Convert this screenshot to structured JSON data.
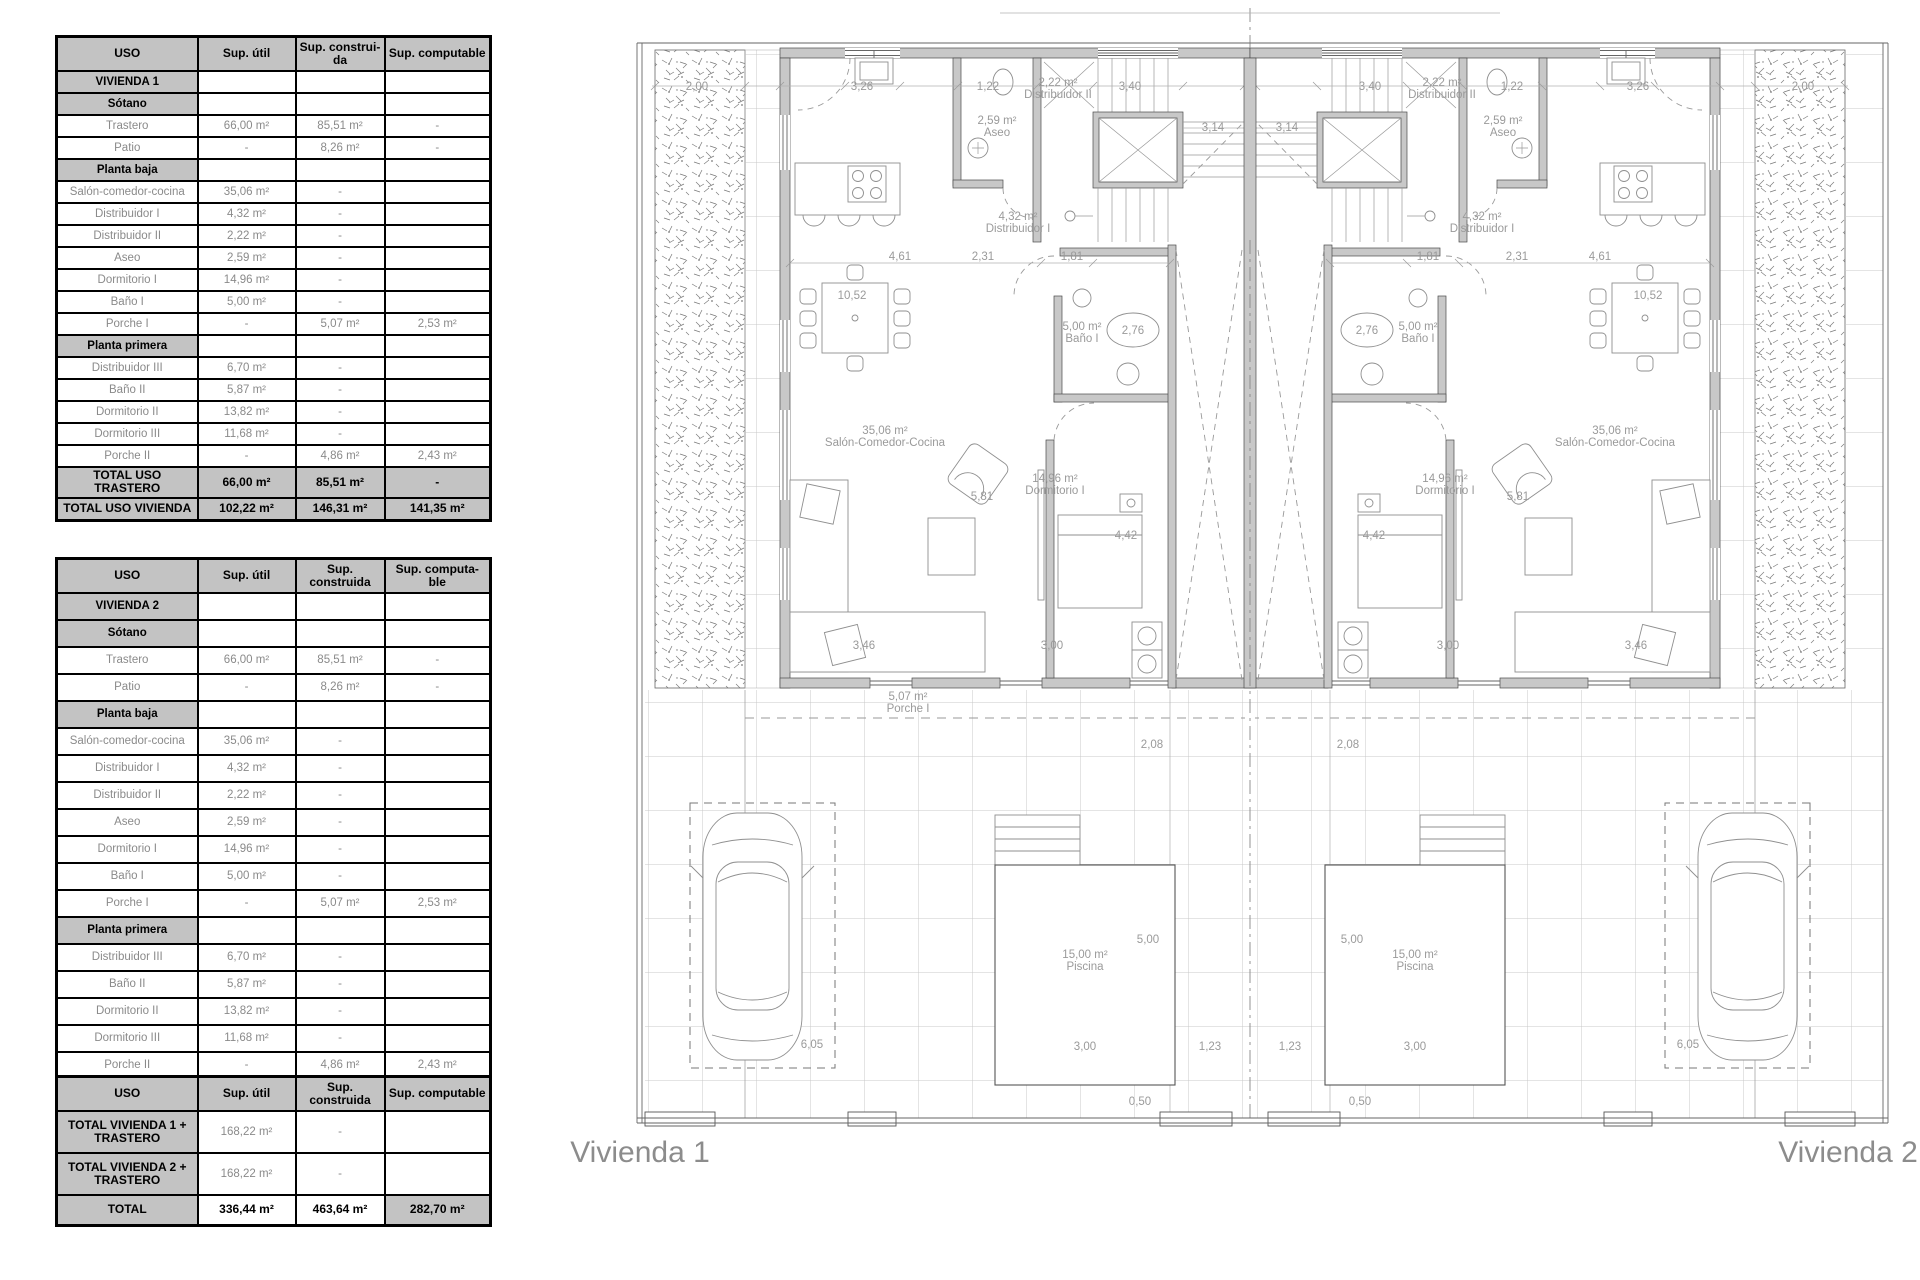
{
  "colors": {
    "table_header_bg": "#c3c3c3",
    "data_text": "#8a8a8a",
    "wall_fill": "#c8c8c8",
    "plan_text": "#9a9a9a",
    "title_text": "#8c8c8c"
  },
  "tables": {
    "table1": {
      "headers": [
        "USO",
        "Sup. útil",
        "Sup. construi-\nda",
        "Sup. computable"
      ],
      "rows": [
        [
          "section",
          "VIVIENDA 1",
          "",
          "",
          ""
        ],
        [
          "section",
          "Sótano",
          "",
          "",
          ""
        ],
        [
          "data",
          "Trastero",
          "66,00 m²",
          "85,51 m²",
          "-"
        ],
        [
          "data",
          "Patio",
          "-",
          "8,26 m²",
          "-"
        ],
        [
          "section",
          "Planta baja",
          "",
          "",
          ""
        ],
        [
          "data",
          "Salón-comedor-cocina",
          "35,06 m²",
          "-",
          ""
        ],
        [
          "data",
          "Distribuidor I",
          "4,32 m²",
          "-",
          ""
        ],
        [
          "data",
          "Distribuidor II",
          "2,22 m²",
          "-",
          ""
        ],
        [
          "data",
          "Aseo",
          "2,59 m²",
          "-",
          ""
        ],
        [
          "data",
          "Dormitorio I",
          "14,96 m²",
          "-",
          ""
        ],
        [
          "data",
          "Baño I",
          "5,00 m²",
          "-",
          ""
        ],
        [
          "data",
          "Porche I",
          "-",
          "5,07 m²",
          "2,53 m²"
        ],
        [
          "section",
          "Planta primera",
          "",
          "",
          ""
        ],
        [
          "data",
          "Distribuidor III",
          "6,70 m²",
          "-",
          ""
        ],
        [
          "data",
          "Baño II",
          "5,87 m²",
          "-",
          ""
        ],
        [
          "data",
          "Dormitorio II",
          "13,82 m²",
          "-",
          ""
        ],
        [
          "data",
          "Dormitorio III",
          "11,68 m²",
          "-",
          ""
        ],
        [
          "data",
          "Porche II",
          "-",
          "4,86 m²",
          "2,43 m²"
        ],
        [
          "total",
          "TOTAL USO TRASTERO",
          "66,00 m²",
          "85,51 m²",
          "-"
        ],
        [
          "total",
          "TOTAL USO VIVIENDA",
          "102,22 m²",
          "146,31 m²",
          "141,35 m²"
        ]
      ]
    },
    "table2": {
      "headers": [
        "USO",
        "Sup. útil",
        "Sup. construida",
        "Sup. computa-\nble"
      ],
      "rows": [
        [
          "section",
          "VIVIENDA 2",
          "",
          "",
          ""
        ],
        [
          "section",
          "Sótano",
          "",
          "",
          ""
        ],
        [
          "data",
          "Trastero",
          "66,00 m²",
          "85,51 m²",
          "-"
        ],
        [
          "data",
          "Patio",
          "-",
          "8,26 m²",
          "-"
        ],
        [
          "section",
          "Planta baja",
          "",
          "",
          ""
        ],
        [
          "data",
          "Salón-comedor-cocina",
          "35,06 m²",
          "-",
          ""
        ],
        [
          "data",
          "Distribuidor I",
          "4,32 m²",
          "-",
          ""
        ],
        [
          "data",
          "Distribuidor II",
          "2,22 m²",
          "-",
          ""
        ],
        [
          "data",
          "Aseo",
          "2,59 m²",
          "-",
          ""
        ],
        [
          "data",
          "Dormitorio I",
          "14,96 m²",
          "-",
          ""
        ],
        [
          "data",
          "Baño I",
          "5,00 m²",
          "-",
          ""
        ],
        [
          "data",
          "Porche I",
          "-",
          "5,07 m²",
          "2,53 m²"
        ],
        [
          "section",
          "Planta primera",
          "",
          "",
          ""
        ],
        [
          "data",
          "Distribuidor III",
          "6,70 m²",
          "-",
          ""
        ],
        [
          "data",
          "Baño II",
          "5,87 m²",
          "-",
          ""
        ],
        [
          "data",
          "Dormitorio II",
          "13,82 m²",
          "-",
          ""
        ],
        [
          "data",
          "Dormitorio III",
          "11,68 m²",
          "-",
          ""
        ],
        [
          "data",
          "Porche II",
          "-",
          "4,86 m²",
          "2,43 m²"
        ],
        [
          "total",
          "TOTAL USO TRASTERO",
          "66,00 m²",
          "85,51 m²",
          "-"
        ],
        [
          "total",
          "TOTAL USO VIVIENDA",
          "102,22 m²",
          "146,31 m²",
          "141,35 m²"
        ]
      ]
    },
    "table3": {
      "headers": [
        "USO",
        "Sup. útil",
        "Sup. construida",
        "Sup. computable"
      ],
      "rows": [
        [
          "total2",
          "TOTAL VIVIENDA 1 +\nTRASTERO",
          "168,22 m²",
          "-",
          ""
        ],
        [
          "total2",
          "TOTAL VIVIENDA 2 +\nTRASTERO",
          "168,22 m²",
          "-",
          ""
        ],
        [
          "grand",
          "TOTAL",
          "336,44 m²",
          "463,64 m²",
          "282,70 m²"
        ]
      ]
    }
  },
  "plan": {
    "texts": [
      {
        "t": "Vivienda 1",
        "x": 640,
        "y": 1162,
        "cls": "title",
        "anchor": "start",
        "name": "title-vivienda-1"
      },
      {
        "t": "Vivienda 2",
        "x": 1848,
        "y": 1162,
        "cls": "title",
        "anchor": "end",
        "name": "title-vivienda-2"
      },
      {
        "t": "2,59 m²",
        "x": 997,
        "y": 124
      },
      {
        "t": "Aseo",
        "x": 997,
        "y": 136
      },
      {
        "t": "2,59 m²",
        "x": 1503,
        "y": 124
      },
      {
        "t": "Aseo",
        "x": 1503,
        "y": 136
      },
      {
        "t": "2,22 m²",
        "x": 1058,
        "y": 86
      },
      {
        "t": "Distribuidor II",
        "x": 1058,
        "y": 98
      },
      {
        "t": "2,22 m²",
        "x": 1442,
        "y": 86
      },
      {
        "t": "Distribuidor II",
        "x": 1442,
        "y": 98
      },
      {
        "t": "4,32 m²",
        "x": 1018,
        "y": 220
      },
      {
        "t": "Distribuidor I",
        "x": 1018,
        "y": 232
      },
      {
        "t": "4,32 m²",
        "x": 1482,
        "y": 220
      },
      {
        "t": "Distribuidor I",
        "x": 1482,
        "y": 232
      },
      {
        "t": "5,00 m²",
        "x": 1082,
        "y": 330
      },
      {
        "t": "Baño I",
        "x": 1082,
        "y": 342
      },
      {
        "t": "5,00 m²",
        "x": 1418,
        "y": 330
      },
      {
        "t": "Baño I",
        "x": 1418,
        "y": 342
      },
      {
        "t": "35,06 m²",
        "x": 885,
        "y": 434
      },
      {
        "t": "Salón-Comedor-Cocina",
        "x": 885,
        "y": 446
      },
      {
        "t": "35,06 m²",
        "x": 1615,
        "y": 434
      },
      {
        "t": "Salón-Comedor-Cocina",
        "x": 1615,
        "y": 446
      },
      {
        "t": "14,96 m²",
        "x": 1055,
        "y": 482
      },
      {
        "t": "Dormitorio I",
        "x": 1055,
        "y": 494
      },
      {
        "t": "14,96 m²",
        "x": 1445,
        "y": 482
      },
      {
        "t": "Dormitorio I",
        "x": 1445,
        "y": 494
      },
      {
        "t": "15,00 m²",
        "x": 1085,
        "y": 958
      },
      {
        "t": "Piscina",
        "x": 1085,
        "y": 970
      },
      {
        "t": "15,00 m²",
        "x": 1415,
        "y": 958
      },
      {
        "t": "Piscina",
        "x": 1415,
        "y": 970
      },
      {
        "t": "5,07 m²",
        "x": 908,
        "y": 700
      },
      {
        "t": "Porche I",
        "x": 908,
        "y": 712
      },
      {
        "t": "2,76",
        "x": 1133,
        "y": 334
      },
      {
        "t": "2,76",
        "x": 1367,
        "y": 334
      },
      {
        "t": "2,00",
        "x": 697,
        "y": 90
      },
      {
        "t": "2,00",
        "x": 1803,
        "y": 90
      },
      {
        "t": "3,26",
        "x": 862,
        "y": 90
      },
      {
        "t": "3,26",
        "x": 1638,
        "y": 90
      },
      {
        "t": "1,22",
        "x": 988,
        "y": 90
      },
      {
        "t": "1,22",
        "x": 1512,
        "y": 90
      },
      {
        "t": "3,40",
        "x": 1130,
        "y": 90
      },
      {
        "t": "3,40",
        "x": 1370,
        "y": 90
      },
      {
        "t": "3,14",
        "x": 1213,
        "y": 131
      },
      {
        "t": "3,14",
        "x": 1287,
        "y": 131
      },
      {
        "t": "4,61",
        "x": 900,
        "y": 260
      },
      {
        "t": "4,61",
        "x": 1600,
        "y": 260
      },
      {
        "t": "2,31",
        "x": 983,
        "y": 260
      },
      {
        "t": "2,31",
        "x": 1517,
        "y": 260
      },
      {
        "t": "1,81",
        "x": 1072,
        "y": 260
      },
      {
        "t": "1,81",
        "x": 1428,
        "y": 260
      },
      {
        "t": "10,52",
        "x": 852,
        "y": 299
      },
      {
        "t": "10,52",
        "x": 1648,
        "y": 299
      },
      {
        "t": "5,81",
        "x": 982,
        "y": 500
      },
      {
        "t": "5,81",
        "x": 1518,
        "y": 500
      },
      {
        "t": "4,42",
        "x": 1126,
        "y": 539
      },
      {
        "t": "4,42",
        "x": 1374,
        "y": 539
      },
      {
        "t": "3,46",
        "x": 864,
        "y": 649
      },
      {
        "t": "3,46",
        "x": 1636,
        "y": 649
      },
      {
        "t": "3,00",
        "x": 1052,
        "y": 649
      },
      {
        "t": "3,00",
        "x": 1448,
        "y": 649
      },
      {
        "t": "2,08",
        "x": 1152,
        "y": 748
      },
      {
        "t": "2,08",
        "x": 1348,
        "y": 748
      },
      {
        "t": "5,00",
        "x": 1148,
        "y": 943
      },
      {
        "t": "5,00",
        "x": 1352,
        "y": 943
      },
      {
        "t": "3,00",
        "x": 1085,
        "y": 1050
      },
      {
        "t": "3,00",
        "x": 1415,
        "y": 1050
      },
      {
        "t": "1,23",
        "x": 1210,
        "y": 1050
      },
      {
        "t": "1,23",
        "x": 1290,
        "y": 1050
      },
      {
        "t": "0,50",
        "x": 1140,
        "y": 1105
      },
      {
        "t": "0,50",
        "x": 1360,
        "y": 1105
      },
      {
        "t": "6,05",
        "x": 812,
        "y": 1048
      },
      {
        "t": "6,05",
        "x": 1688,
        "y": 1048
      }
    ]
  }
}
